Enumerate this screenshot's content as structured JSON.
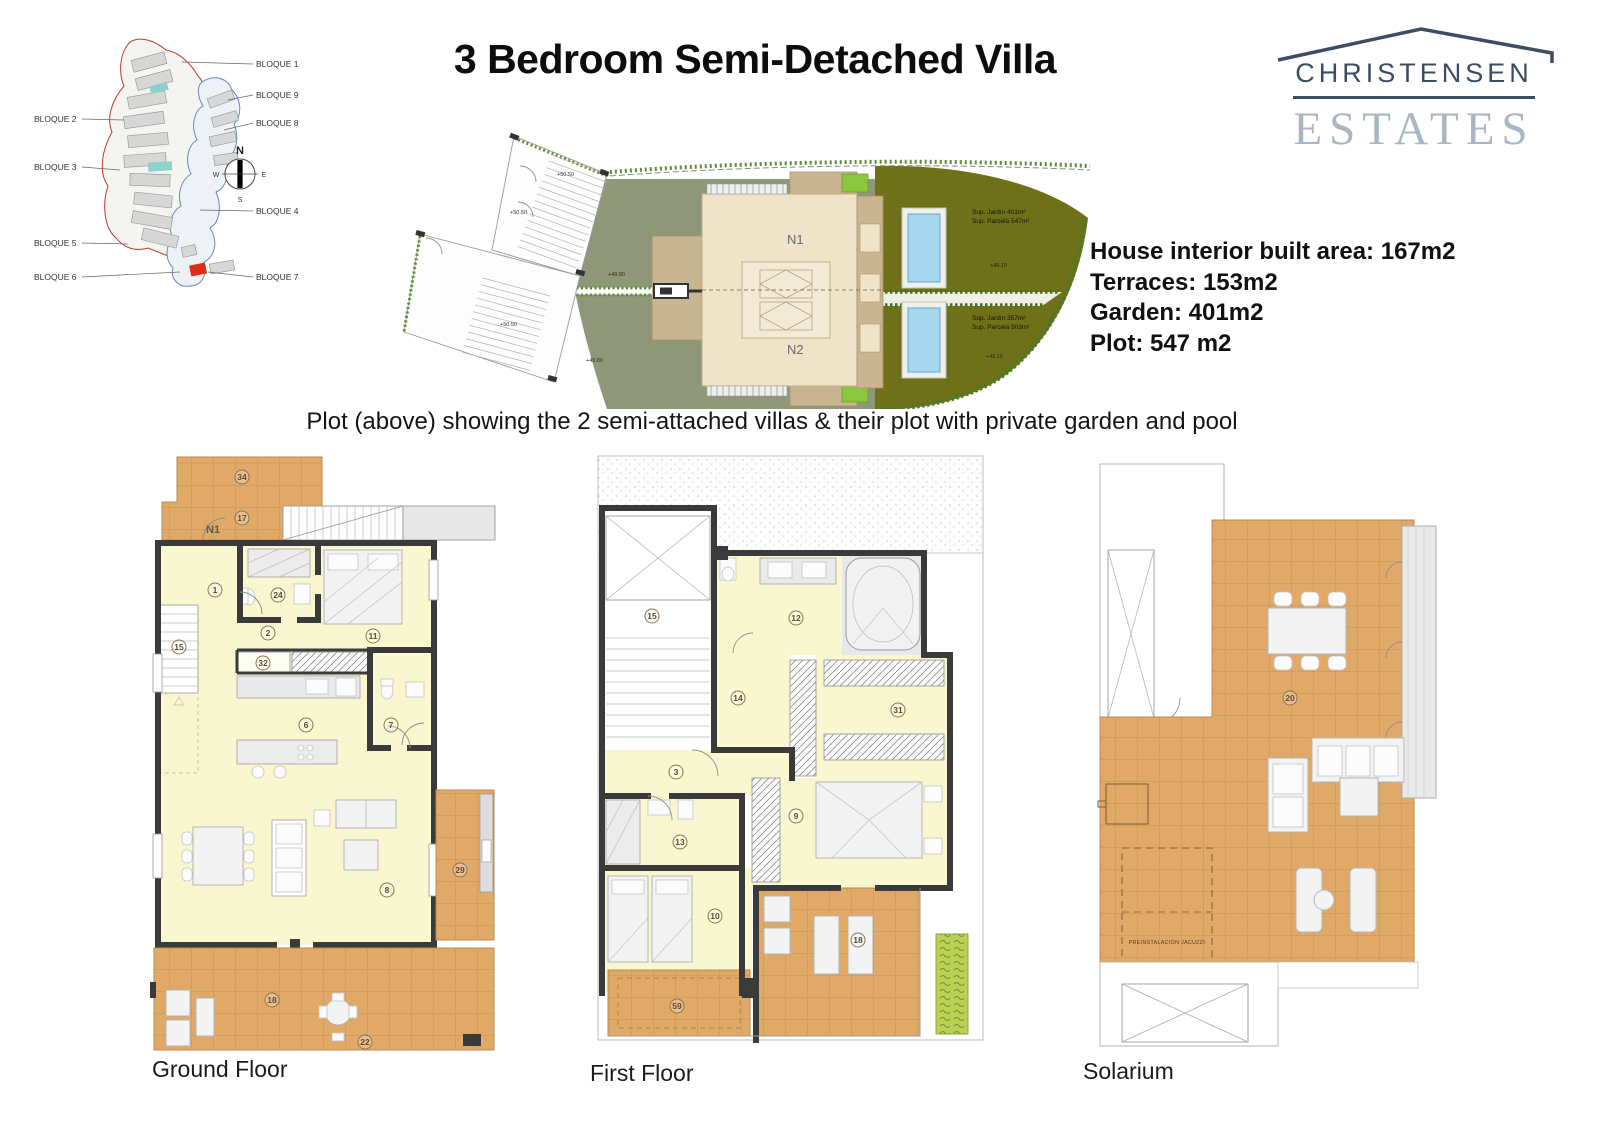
{
  "header": {
    "title": "3 Bedroom Semi-Detached Villa",
    "logo_name": "CHRISTENSEN",
    "logo_type": "ESTATES"
  },
  "site_map": {
    "blocks": [
      "BLOQUE 1",
      "BLOQUE 9",
      "BLOQUE 8",
      "BLOQUE 4",
      "BLOQUE 7",
      "BLOQUE 2",
      "BLOQUE 3",
      "BLOQUE 5",
      "BLOQUE 6"
    ],
    "compass": {
      "n": "N",
      "e": "E",
      "s": "S",
      "w": "W"
    }
  },
  "plot_plan": {
    "units": {
      "n1": "N1",
      "n2": "N2"
    },
    "garden_top": {
      "jardin": "Sup. Jardín 401m²",
      "parcela": "Sup. Parcela 547m²",
      "level": "+49.10"
    },
    "garden_bottom": {
      "jardin": "Sup. Jardín 357m²",
      "parcela": "Sup. Parcela 503m²",
      "level": "+49.10"
    },
    "levels": {
      "l1": "+50.50",
      "l2": "+50.50",
      "l3": "+50.50",
      "l4": "+49.80",
      "l5": "+49.80"
    },
    "caption": "Plot (above) showing the 2 semi-attached villas & their plot with private garden and pool"
  },
  "specs": {
    "area": "House interior built area: 167m2",
    "terraces": "Terraces: 153m2",
    "garden": "Garden: 401m2",
    "plot": "Plot: 547 m2"
  },
  "ground_floor": {
    "label": "Ground Floor",
    "unit": "N1",
    "rooms": {
      "r34": "34",
      "r17": "17",
      "r1": "1",
      "r24": "24",
      "r2": "2",
      "r11": "11",
      "r15": "15",
      "r32": "32",
      "r6": "6",
      "r7": "7",
      "r8": "8",
      "r29": "29",
      "r18": "18",
      "r22": "22"
    }
  },
  "first_floor": {
    "label": "First Floor",
    "rooms": {
      "r15": "15",
      "r12": "12",
      "r14": "14",
      "r31": "31",
      "r3": "3",
      "r13": "13",
      "r9": "9",
      "r10": "10",
      "r18": "18",
      "r59": "59"
    }
  },
  "solarium": {
    "label": "Solarium",
    "rooms": {
      "r20": "20"
    },
    "note": "PREINSTALACION JACUZZI"
  },
  "colors": {
    "brand_dark": "#3c4d63",
    "brand_light": "#a9b5c3",
    "terrace": "#e0a968",
    "interior": "#f9f7cf",
    "lawn": "#8e9878",
    "garden": "#6f7119",
    "pool": "#a6d7ef",
    "lime": "#8cc63e"
  }
}
